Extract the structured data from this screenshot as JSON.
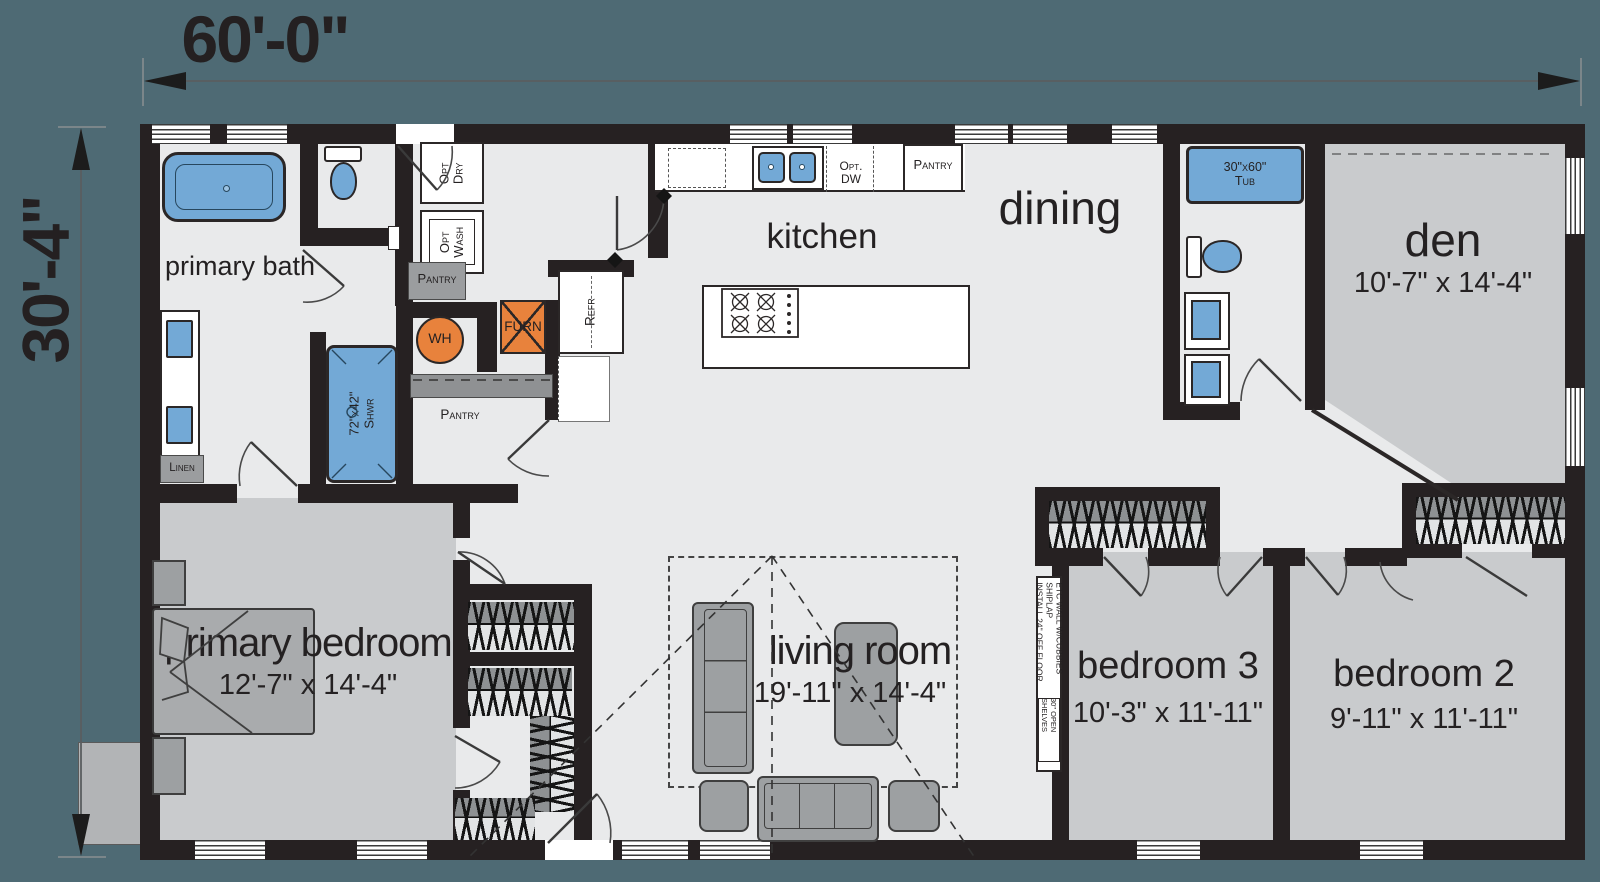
{
  "dims": {
    "width_label": "60'-0\"",
    "height_label": "30'-4\""
  },
  "rooms": {
    "primary_bath": {
      "name": "primary bath"
    },
    "kitchen": {
      "name": "kitchen"
    },
    "dining": {
      "name": "dining"
    },
    "den": {
      "name": "den",
      "size": "10'-7\" x 14'-4\""
    },
    "primary_bedroom": {
      "name": "primary bedroom",
      "size": "12'-7\" x 14'-4\""
    },
    "living_room": {
      "name": "living room",
      "size": "19'-11\" x 14'-4\""
    },
    "bedroom_3": {
      "name": "bedroom 3",
      "size": "10'-3\" x 11'-11\""
    },
    "bedroom_2": {
      "name": "bedroom 2",
      "size": "9'-11\" x 11'-11\""
    }
  },
  "fixtures": {
    "opt_dry": [
      "Opt",
      "Dry"
    ],
    "opt_wash": [
      "Opt",
      "Wash"
    ],
    "pantry_utility": "Pantry",
    "pantry_walkin": "Pantry",
    "pantry_kitchen": "Pantry",
    "wh": "WH",
    "furn": "FURN",
    "refr": "Refr",
    "opt_dw": [
      "Opt.",
      "DW"
    ],
    "linen": "Linen",
    "shower": [
      "72\"x42\"",
      "Shwr"
    ],
    "tub": [
      "30\"x60\"",
      "Tub"
    ]
  },
  "notes": {
    "etc_wall": [
      "ETC WALL W/CUBBIES",
      "SHIPLAP",
      "INSTALL 24\" OFF FLOOR"
    ],
    "open_shelves": [
      "30\" OPEN",
      "SHELVES"
    ]
  },
  "colors": {
    "canvas": "#4e6a74",
    "wall": "#262122",
    "floor_light": "#e9eaeb",
    "floor_gray": "#c9cbcd",
    "fixture_blue": "#73a9d6",
    "fixture_orange": "#e8823c"
  }
}
